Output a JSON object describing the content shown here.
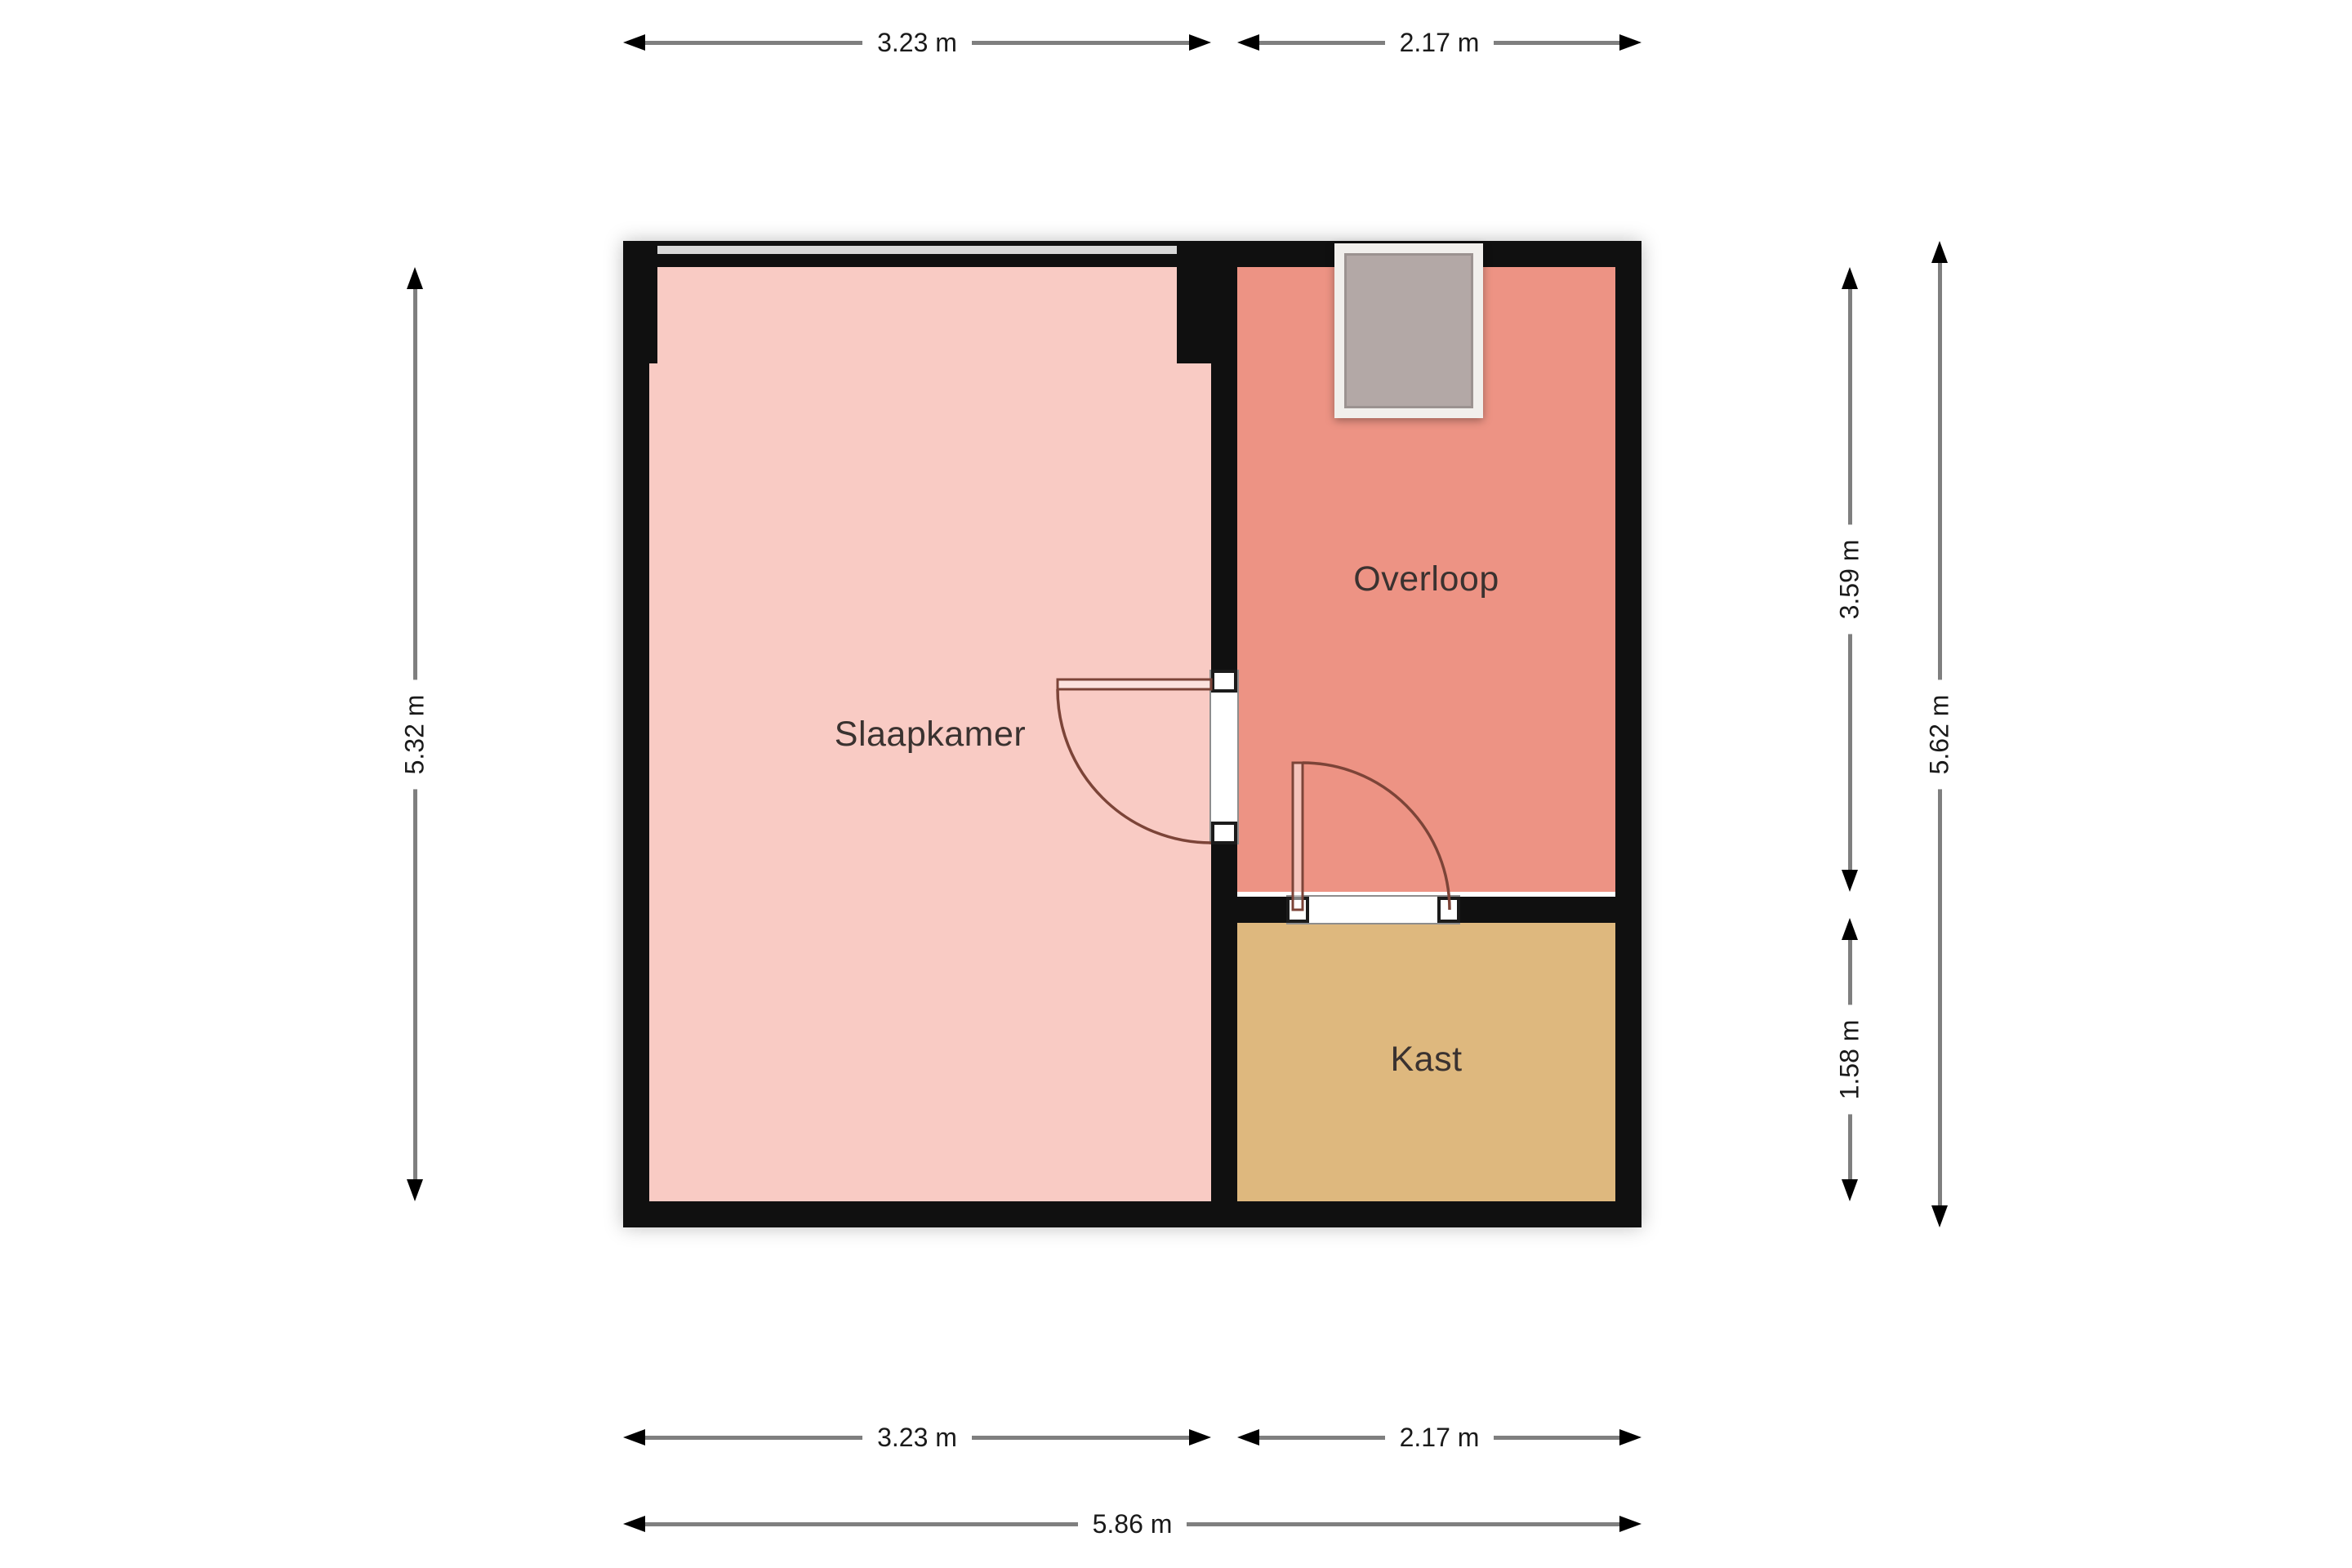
{
  "floorplan": {
    "rooms": [
      {
        "label": "Slaapkamer",
        "color": "#f9cbc4"
      },
      {
        "label": "Overloop",
        "color": "#ed9384"
      },
      {
        "label": "Kast",
        "color": "#deb87e"
      }
    ],
    "colors": {
      "wall": "#101010",
      "window": "#d8d8d8",
      "door": "#7c4438",
      "dimension_line": "#7f7f7f",
      "text": "#1a1a1a",
      "stairwell_fill": "#b3a8a6",
      "stairwell_frame": "#f1efec"
    },
    "dimensions": {
      "top": [
        "3.23 m",
        "2.17 m"
      ],
      "bottom": [
        "3.23 m",
        "2.17 m"
      ],
      "bottom_total": "5.86 m",
      "left": "5.32 m",
      "right": [
        "3.59 m",
        "1.58 m"
      ],
      "right_total": "5.62 m"
    }
  }
}
